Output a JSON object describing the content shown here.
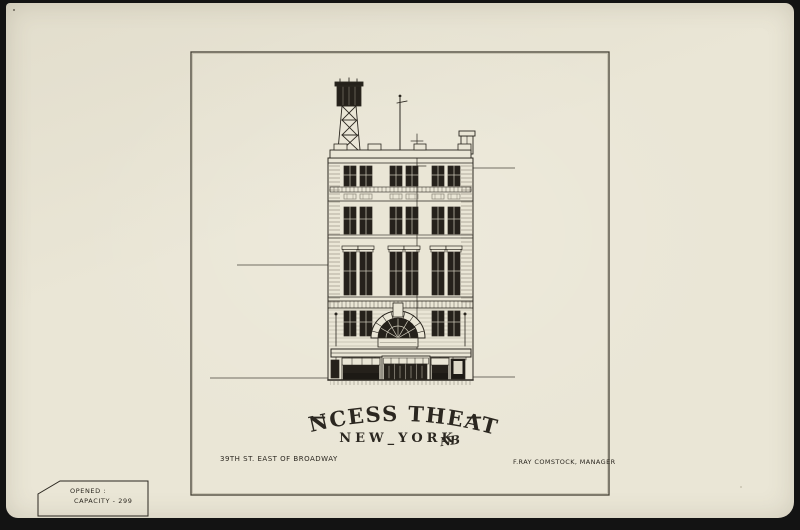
{
  "artwork": {
    "title": "PRINCESS THEATRE",
    "title_dash_left": "—",
    "title_dash_right": "—",
    "subtitle": "NEW_YORK",
    "signature_monogram": "NB",
    "address": "39TH ST. EAST OF BROADWAY",
    "manager": "F.RAY COMSTOCK, MANAGER"
  },
  "corner_label": {
    "line1": "OPENED :",
    "line2": "CAPACITY - 299"
  },
  "icons": {
    "water_tank_tower": "lattice-water-tank-tower",
    "flagpole": "rooftop-flagpole",
    "chimney": "rooftop-chimney"
  },
  "colors": {
    "photo_background": "#131313",
    "paper": "#eae6d6",
    "ink": "#2b2720",
    "window_glass": "#25211b",
    "line_light": "#8a8578",
    "poster_dark": "#1d1a15"
  }
}
